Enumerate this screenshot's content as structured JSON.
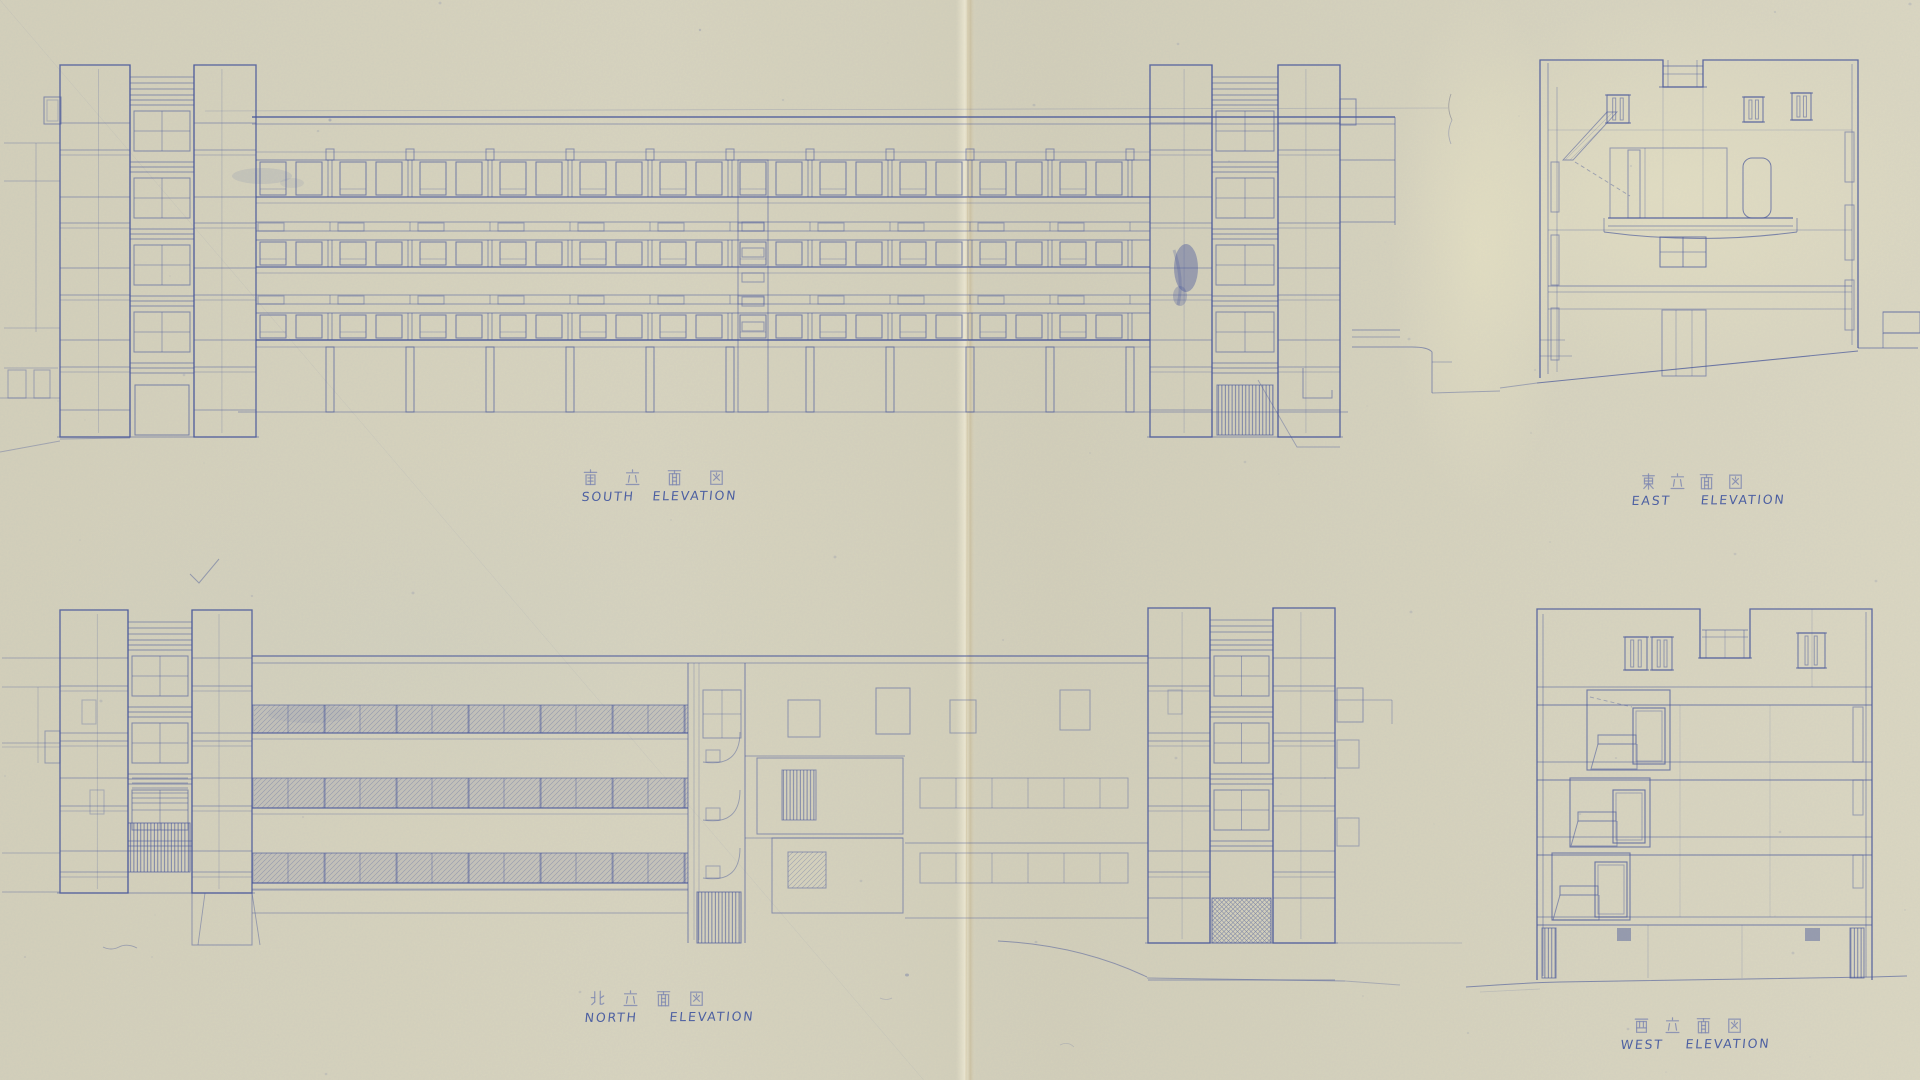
{
  "sheet": {
    "paper_color": "#d7d3bd",
    "ink_color": "#47569a",
    "pencil_color": "#6874ae"
  },
  "views": {
    "south": {
      "kanji": "南立面図",
      "label": "SOUTH ELEVATION"
    },
    "east": {
      "kanji": "東立面図",
      "label": "EAST ELEVATION"
    },
    "north": {
      "kanji": "北立面図",
      "label": "NORTH ELEVATION"
    },
    "west": {
      "kanji": "西立面図",
      "label": "WEST ELEVATION"
    }
  }
}
